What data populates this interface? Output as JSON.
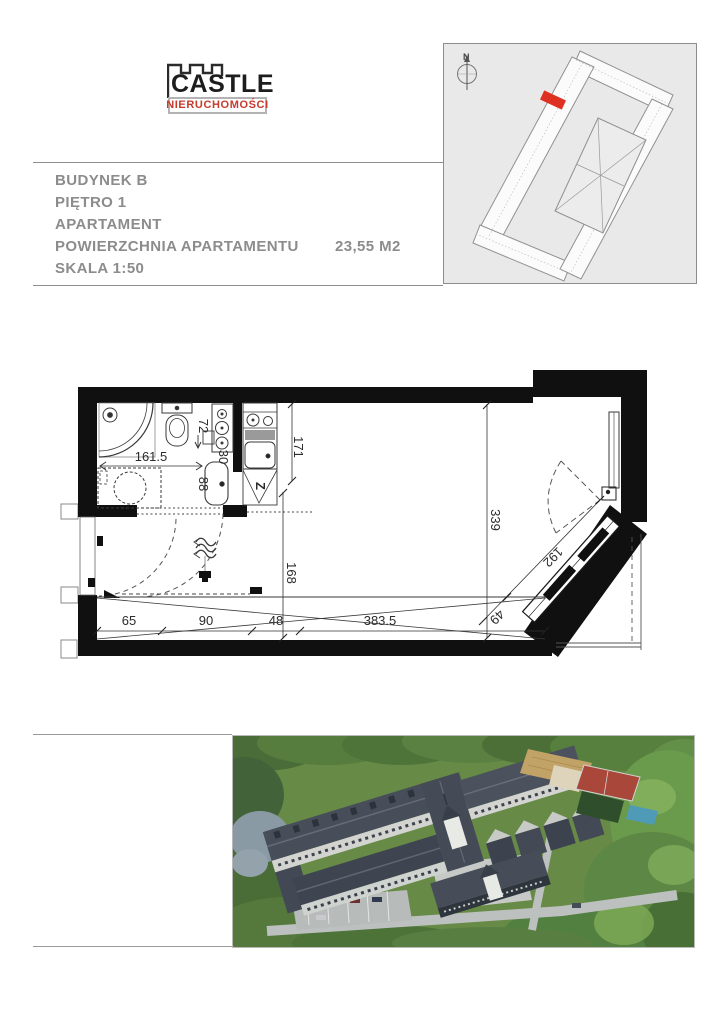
{
  "logo": {
    "title": "CASTLE",
    "subtitle": "NIERUCHOMOŚCI",
    "accent_color": "#c63b2c"
  },
  "header_info": {
    "building": "BUDYNEK B",
    "floor": "PIĘTRO 1",
    "unit_type": "APARTAMENT",
    "area_label": "POWIERZCHNIA APARTAMENTU",
    "area_value": "23,55 M2",
    "scale": "SKALA 1:50"
  },
  "site_plan": {
    "north_label": "N",
    "highlight_color": "#de3122"
  },
  "floor_plan": {
    "labels": {
      "bath_width": "161.5",
      "toilet_zone": "72",
      "niche": "30",
      "basin_zone": "88",
      "kitchen_length": "171",
      "room_depth": "339",
      "hall_depth": "168",
      "wardrobe_1": "65",
      "wardrobe_2": "90",
      "wardrobe_3": "48",
      "room_width": "383.5",
      "glazing_length": "192",
      "glazing_end": "49",
      "sink_symbol": "Z"
    }
  }
}
